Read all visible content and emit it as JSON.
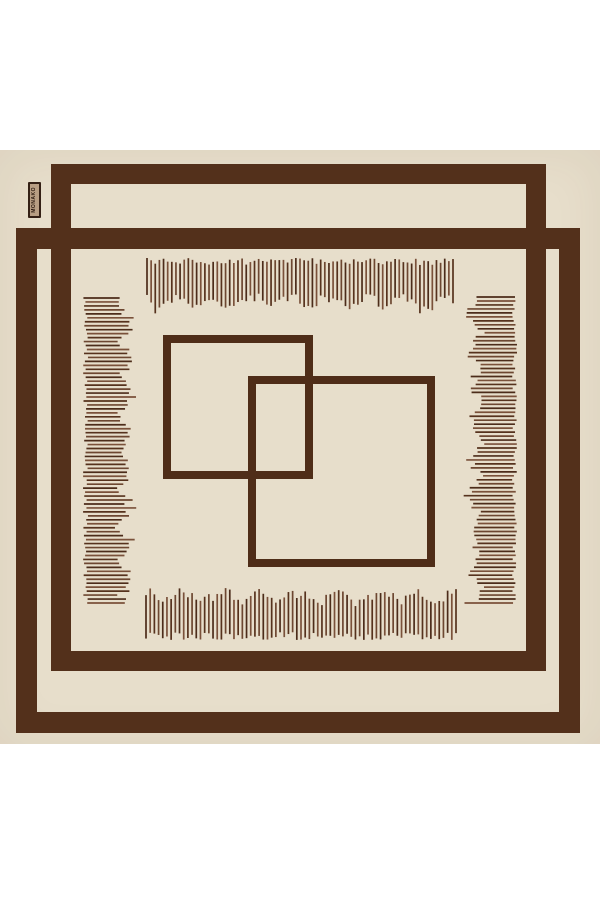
{
  "product": {
    "brand_label": {
      "text": "MONAKO"
    }
  },
  "design": {
    "colors": {
      "page_bg": "#ffffff",
      "fabric": "#e7decb",
      "frame": "#53301b",
      "square": "#4f2d18",
      "fringe_dark": "#4c2c1a",
      "fringe_mid": "#7a513a",
      "fringe_alt1": "#56321d",
      "fringe_alt2": "#6d4731",
      "label_bg": "#b89e83",
      "label_border": "#342015",
      "label_text": "#2c1a10"
    },
    "frames": [
      {
        "name": "scarf-frame-upper",
        "x": 51,
        "y": 14,
        "w": 495,
        "h": 507,
        "stroke": 20
      },
      {
        "name": "scarf-frame-lower",
        "x": 16,
        "y": 78,
        "w": 564,
        "h": 505,
        "stroke": 21
      }
    ],
    "squares": [
      {
        "name": "center-square-1",
        "x": 163,
        "y": 185,
        "w": 150,
        "h": 144,
        "stroke": 8
      },
      {
        "name": "center-square-2",
        "x": 248,
        "y": 226,
        "w": 187,
        "h": 191,
        "stroke": 8
      }
    ],
    "fringes": [
      {
        "name": "top",
        "orient": "v",
        "from": "start",
        "n": 75,
        "a0": 147,
        "a1": 453,
        "edge": 108,
        "minLen": 32,
        "maxLen": 50,
        "jitter": 7
      },
      {
        "name": "bottom",
        "orient": "v",
        "from": "end",
        "n": 75,
        "a0": 146,
        "a1": 456,
        "edge": 490,
        "minLen": 32,
        "maxLen": 48,
        "jitter": 8
      },
      {
        "name": "left",
        "orient": "h",
        "from": "start",
        "n": 78,
        "a0": 148,
        "a1": 453,
        "edge": 83,
        "minLen": 30,
        "maxLen": 50,
        "jitter": 5
      },
      {
        "name": "right",
        "orient": "h",
        "from": "end",
        "n": 78,
        "a0": 147,
        "a1": 453,
        "edge": 517,
        "minLen": 30,
        "maxLen": 50,
        "jitter": 5
      }
    ],
    "line_stroke_width": 1.7
  }
}
